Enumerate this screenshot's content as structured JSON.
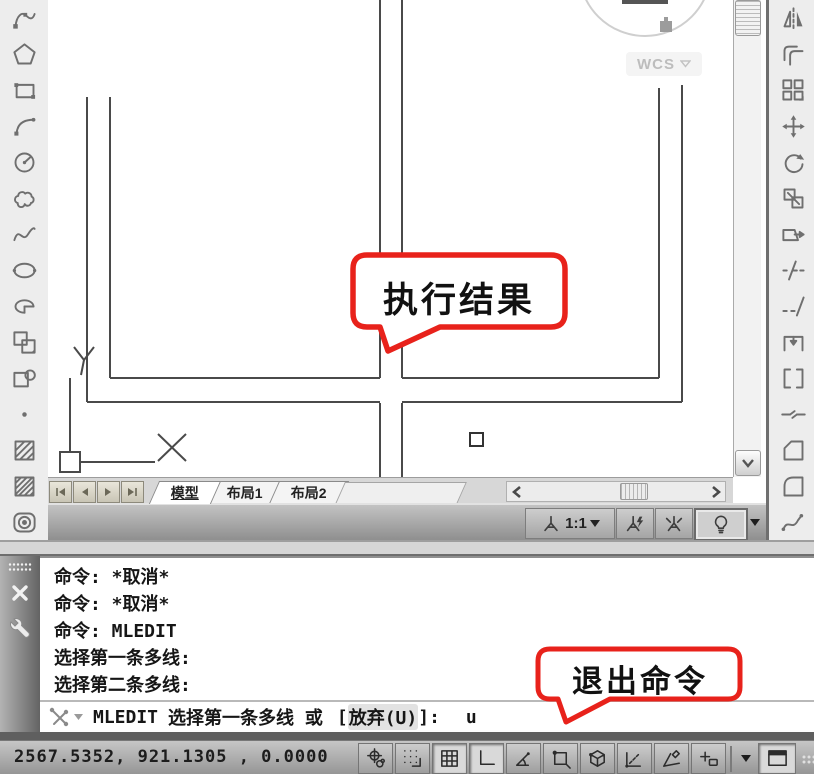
{
  "left_toolbar": {
    "name": "draw-toolbar",
    "icons": [
      "polyline",
      "polygon",
      "rectangle",
      "arc",
      "circle",
      "revcloud",
      "spline",
      "ellipse",
      "ellipse-arc",
      "insert-block",
      "make-block",
      "point",
      "hatch",
      "gradient",
      "region"
    ]
  },
  "right_toolbar": {
    "name": "modify-toolbar",
    "icons": [
      "mirror",
      "offset",
      "array",
      "move",
      "rotate",
      "scale",
      "stretch",
      "trim",
      "extend",
      "break-at-point",
      "break",
      "join",
      "chamfer",
      "fillet",
      "blend-curves"
    ]
  },
  "canvas": {
    "objects": [
      "multiline-cross-intersection",
      "ucs-icon",
      "pickbox-cursor",
      "viewcube-remnant"
    ],
    "callout_result": "执行结果",
    "ucs": {
      "x_label": "X",
      "y_label": "Y"
    }
  },
  "viewcube": {
    "wcs_label": "WCS",
    "dropdown_icon": "chevron-down"
  },
  "tab_bar": {
    "nav_icons": [
      "first-tab",
      "previous-tab",
      "next-tab",
      "last-tab"
    ],
    "tabs": [
      {
        "label": "模型",
        "active": true
      },
      {
        "label": "布局1",
        "active": false
      },
      {
        "label": "布局2",
        "active": false
      }
    ]
  },
  "annotation_bar": {
    "scale_label": "1:1",
    "buttons": [
      "annotation-scale",
      "annotation-visibility",
      "annotation-autoscale",
      "lightbulb-toggle",
      "annotation-menu"
    ]
  },
  "command_window": {
    "grab_icons": [
      "grip-dots",
      "close",
      "wrench"
    ],
    "history": [
      "命令: *取消*",
      "命令: *取消*",
      "命令:  MLEDIT",
      "选择第一条多线:",
      "选择第二条多线:"
    ],
    "prompt": {
      "icon": "recent-commands",
      "command": "MLEDIT",
      "text": "选择第一条多线 或",
      "option_open": "[",
      "option": "放弃(U)",
      "option_close": "]:",
      "input": "u"
    },
    "callout_exit": "退出命令"
  },
  "status_bar": {
    "coordinates": "2567.5352, 921.1305 , 0.0000",
    "buttons": [
      "snap",
      "grid-display",
      "grid",
      "ortho",
      "polar-tracking",
      "object-snap",
      "3d-object-snap",
      "object-snap-tracking",
      "dynamic-ucs",
      "dynamic-input",
      "statusbar-menu",
      "clean-screen"
    ]
  },
  "colors": {
    "callout_red": "#e8221b",
    "drawing_line": "#4a4a4a",
    "toolbar_bg": "#ededed"
  }
}
